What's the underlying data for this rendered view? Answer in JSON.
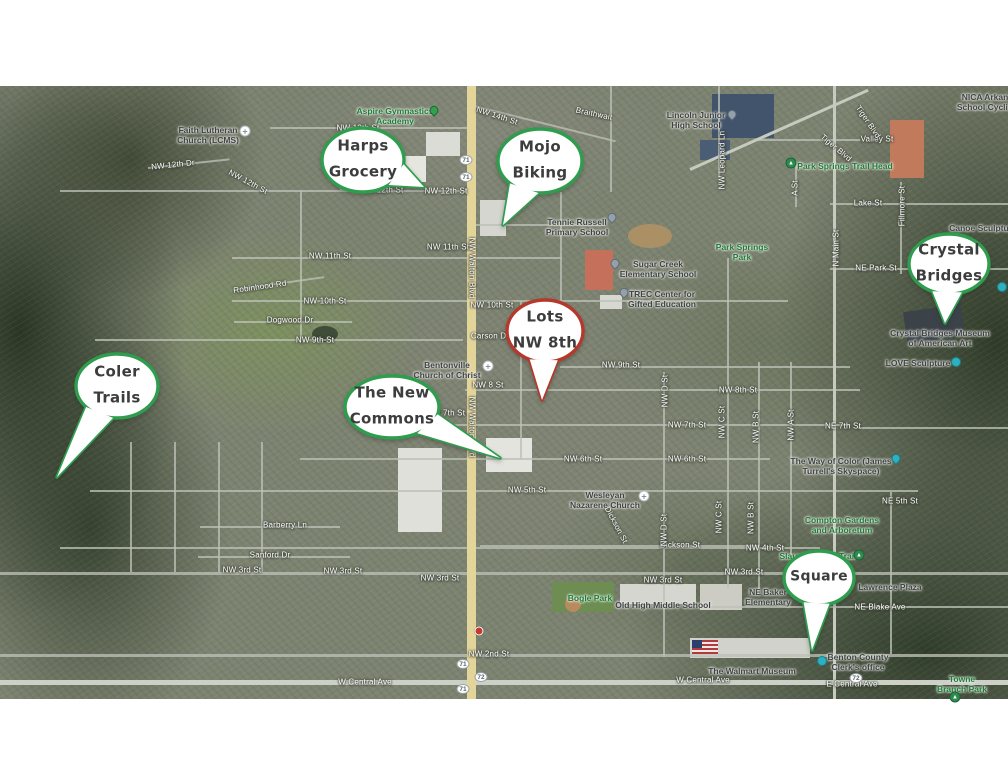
{
  "map": {
    "colors": {
      "callout_green": "#2f9d4e",
      "callout_red": "#b5392b",
      "highway_yellow": "#e3d49a",
      "street_gray": "#bcc0b6"
    },
    "callouts": [
      {
        "id": "harps-grocery",
        "lines": [
          "Harps",
          "Grocery"
        ],
        "cx": 363,
        "cy": 160,
        "rx": 41,
        "ry": 32,
        "tip": [
          424,
          187
        ],
        "color": "#2f9d4e"
      },
      {
        "id": "mojo-biking",
        "lines": [
          "Mojo",
          "Biking"
        ],
        "cx": 540,
        "cy": 161,
        "rx": 42,
        "ry": 32,
        "tip": [
          503,
          225
        ],
        "color": "#2f9d4e"
      },
      {
        "id": "crystal-bridges",
        "lines": [
          "Crystal",
          "Bridges"
        ],
        "cx": 949,
        "cy": 264,
        "rx": 40,
        "ry": 30,
        "tip": [
          945,
          323
        ],
        "color": "#2f9d4e"
      },
      {
        "id": "lots-nw-8th",
        "lines": [
          "Lots",
          "NW 8th"
        ],
        "cx": 545,
        "cy": 331,
        "rx": 38,
        "ry": 31,
        "tip": [
          542,
          400
        ],
        "color": "#b5392b"
      },
      {
        "id": "coler-trails",
        "lines": [
          "Coler",
          "Trails"
        ],
        "cx": 117,
        "cy": 386,
        "rx": 41,
        "ry": 32,
        "tip": [
          57,
          477
        ],
        "color": "#2f9d4e"
      },
      {
        "id": "the-new-commons",
        "lines": [
          "The New",
          "Commons"
        ],
        "cx": 392,
        "cy": 407,
        "rx": 47,
        "ry": 31,
        "tip": [
          500,
          458
        ],
        "color": "#2f9d4e"
      },
      {
        "id": "square",
        "lines": [
          "Square"
        ],
        "cx": 819,
        "cy": 578,
        "rx": 35,
        "ry": 27,
        "tip": [
          812,
          650
        ],
        "color": "#2f9d4e"
      }
    ],
    "roads": [
      {
        "x": 270,
        "y": 127,
        "w": 200,
        "h": 2
      },
      {
        "x": 470,
        "y": 104,
        "w": 150,
        "h": 2,
        "r": 14
      },
      {
        "x": 60,
        "y": 190,
        "w": 408,
        "h": 2
      },
      {
        "x": 148,
        "y": 167,
        "w": 82,
        "h": 2,
        "r": -6
      },
      {
        "x": 470,
        "y": 224,
        "w": 135,
        "h": 2
      },
      {
        "x": 232,
        "y": 257,
        "w": 330,
        "h": 2
      },
      {
        "x": 232,
        "y": 300,
        "w": 556,
        "h": 2
      },
      {
        "x": 95,
        "y": 339,
        "w": 368,
        "h": 2
      },
      {
        "x": 560,
        "y": 366,
        "w": 290,
        "h": 2
      },
      {
        "x": 465,
        "y": 389,
        "w": 395,
        "h": 2
      },
      {
        "x": 380,
        "y": 424,
        "w": 470,
        "h": 2
      },
      {
        "x": 858,
        "y": 427,
        "w": 150,
        "h": 2
      },
      {
        "x": 300,
        "y": 458,
        "w": 470,
        "h": 2
      },
      {
        "x": 90,
        "y": 490,
        "w": 828,
        "h": 2
      },
      {
        "x": 60,
        "y": 547,
        "w": 760,
        "h": 2
      },
      {
        "x": 0,
        "y": 572,
        "w": 1008,
        "h": 3
      },
      {
        "x": 480,
        "y": 545,
        "w": 280,
        "h": 2
      },
      {
        "x": 700,
        "y": 606,
        "w": 308,
        "h": 2
      },
      {
        "x": 0,
        "y": 654,
        "w": 1008,
        "h": 3
      },
      {
        "x": 0,
        "y": 680,
        "w": 1008,
        "h": 5,
        "c": "#cdd0c7"
      },
      {
        "x": 830,
        "y": 203,
        "w": 178,
        "h": 2
      },
      {
        "x": 830,
        "y": 268,
        "w": 178,
        "h": 2
      },
      {
        "x": 755,
        "y": 139,
        "w": 105,
        "h": 2
      },
      {
        "x": 233,
        "y": 289,
        "w": 92,
        "h": 2,
        "r": -8
      },
      {
        "x": 234,
        "y": 321,
        "w": 118,
        "h": 2
      },
      {
        "x": 200,
        "y": 526,
        "w": 140,
        "h": 2
      },
      {
        "x": 198,
        "y": 556,
        "w": 152,
        "h": 2
      },
      {
        "x": 467,
        "y": 86,
        "w": 9,
        "h": 613,
        "c": "#e3d49a"
      },
      {
        "x": 833,
        "y": 86,
        "w": 3,
        "h": 613,
        "c": "#c6cabf"
      },
      {
        "x": 663,
        "y": 372,
        "w": 2,
        "h": 285
      },
      {
        "x": 727,
        "y": 258,
        "w": 2,
        "h": 330
      },
      {
        "x": 758,
        "y": 362,
        "w": 2,
        "h": 228
      },
      {
        "x": 790,
        "y": 362,
        "w": 2,
        "h": 196
      },
      {
        "x": 900,
        "y": 182,
        "w": 2,
        "h": 92
      },
      {
        "x": 610,
        "y": 86,
        "w": 2,
        "h": 106
      },
      {
        "x": 560,
        "y": 192,
        "w": 2,
        "h": 110
      },
      {
        "x": 340,
        "y": 128,
        "w": 2,
        "h": 62
      },
      {
        "x": 300,
        "y": 191,
        "w": 2,
        "h": 148
      },
      {
        "x": 130,
        "y": 442,
        "w": 2,
        "h": 130
      },
      {
        "x": 174,
        "y": 442,
        "w": 2,
        "h": 130
      },
      {
        "x": 218,
        "y": 442,
        "w": 2,
        "h": 130
      },
      {
        "x": 261,
        "y": 442,
        "w": 2,
        "h": 130
      },
      {
        "x": 520,
        "y": 301,
        "w": 2,
        "h": 158
      },
      {
        "x": 718,
        "y": 86,
        "w": 2,
        "h": 92
      },
      {
        "x": 795,
        "y": 161,
        "w": 2,
        "h": 46
      },
      {
        "x": 890,
        "y": 492,
        "w": 2,
        "h": 162
      },
      {
        "x": 690,
        "y": 168,
        "w": 195,
        "h": 3,
        "r": -24,
        "c": "#c6cabf"
      }
    ],
    "labels": [
      {
        "t": "NW 13th St",
        "x": 358,
        "y": 128,
        "k": "street"
      },
      {
        "t": "NW 14th St",
        "x": 497,
        "y": 116,
        "k": "street",
        "r": 18
      },
      {
        "t": "NW 12th St",
        "x": 446,
        "y": 191,
        "k": "street"
      },
      {
        "t": "NW 12th St",
        "x": 382,
        "y": 190,
        "k": "street"
      },
      {
        "t": "NW 12th Dr",
        "x": 173,
        "y": 165,
        "k": "street",
        "r": -6
      },
      {
        "t": "NW 12th St",
        "x": 248,
        "y": 182,
        "k": "street",
        "r": 28
      },
      {
        "t": "NW 11th St",
        "x": 330,
        "y": 256,
        "k": "street"
      },
      {
        "t": "NW 11th St",
        "x": 448,
        "y": 247,
        "k": "street"
      },
      {
        "t": "NW 10th St",
        "x": 325,
        "y": 301,
        "k": "street"
      },
      {
        "t": "NW 10th St",
        "x": 492,
        "y": 305,
        "k": "street"
      },
      {
        "t": "NW 9th St",
        "x": 315,
        "y": 340,
        "k": "street"
      },
      {
        "t": "NW 9th St",
        "x": 621,
        "y": 365,
        "k": "street"
      },
      {
        "t": "NW 8 St",
        "x": 488,
        "y": 385,
        "k": "street"
      },
      {
        "t": "NW 8th St",
        "x": 738,
        "y": 390,
        "k": "street"
      },
      {
        "t": "NW 7th St",
        "x": 446,
        "y": 413,
        "k": "street"
      },
      {
        "t": "NW 7th St",
        "x": 687,
        "y": 425,
        "k": "street"
      },
      {
        "t": "NE 7th St",
        "x": 843,
        "y": 426,
        "k": "street"
      },
      {
        "t": "NW 6th St",
        "x": 583,
        "y": 459,
        "k": "street"
      },
      {
        "t": "NW 6th St",
        "x": 687,
        "y": 459,
        "k": "street"
      },
      {
        "t": "NW 5th St",
        "x": 527,
        "y": 490,
        "k": "street"
      },
      {
        "t": "NE 5th St",
        "x": 900,
        "y": 501,
        "k": "street"
      },
      {
        "t": "NW 4th St",
        "x": 765,
        "y": 548,
        "k": "street"
      },
      {
        "t": "NW 3rd St",
        "x": 242,
        "y": 570,
        "k": "street"
      },
      {
        "t": "NW 3rd St",
        "x": 343,
        "y": 571,
        "k": "street"
      },
      {
        "t": "NW 3rd St",
        "x": 440,
        "y": 578,
        "k": "street"
      },
      {
        "t": "NW 3rd St",
        "x": 663,
        "y": 580,
        "k": "street"
      },
      {
        "t": "NW 3rd St",
        "x": 744,
        "y": 572,
        "k": "street"
      },
      {
        "t": "NW 2nd St",
        "x": 489,
        "y": 654,
        "k": "street"
      },
      {
        "t": "W Central Ave",
        "x": 365,
        "y": 682,
        "k": "street"
      },
      {
        "t": "W Central Ave",
        "x": 703,
        "y": 680,
        "k": "street"
      },
      {
        "t": "E Central Ave",
        "x": 852,
        "y": 684,
        "k": "street"
      },
      {
        "t": "NE Blake Ave",
        "x": 880,
        "y": 607,
        "k": "street"
      },
      {
        "t": "Dickson St",
        "x": 616,
        "y": 525,
        "k": "street",
        "r": 62
      },
      {
        "t": "Dickson St",
        "x": 680,
        "y": 545,
        "k": "street"
      },
      {
        "t": "Barberry Ln",
        "x": 285,
        "y": 525,
        "k": "street"
      },
      {
        "t": "Sanford Dr",
        "x": 270,
        "y": 555,
        "k": "street"
      },
      {
        "t": "Carson Dr",
        "x": 490,
        "y": 336,
        "k": "street"
      },
      {
        "t": "Robinhood Rd",
        "x": 260,
        "y": 287,
        "k": "street",
        "r": -8
      },
      {
        "t": "Dogwood Dr",
        "x": 290,
        "y": 320,
        "k": "street"
      },
      {
        "t": "Lake St",
        "x": 868,
        "y": 203,
        "k": "street"
      },
      {
        "t": "Valley St",
        "x": 877,
        "y": 139,
        "k": "street"
      },
      {
        "t": "NE Park St",
        "x": 876,
        "y": 268,
        "k": "street"
      },
      {
        "t": "Tiger Blvd",
        "x": 868,
        "y": 122,
        "k": "street",
        "r": 56
      },
      {
        "t": "Tiger Blvd",
        "x": 836,
        "y": 148,
        "k": "street",
        "r": 40
      },
      {
        "t": "Braithwait",
        "x": 594,
        "y": 114,
        "k": "street",
        "r": 12
      },
      {
        "t": "NW Walton Blvd",
        "x": 472,
        "y": 427,
        "k": "street",
        "r": 90
      },
      {
        "t": "NW Walton Blvd",
        "x": 472,
        "y": 268,
        "k": "street",
        "r": 90
      },
      {
        "t": "N Main St",
        "x": 836,
        "y": 248,
        "k": "street",
        "r": -90
      },
      {
        "t": "Fillmore St",
        "x": 902,
        "y": 206,
        "k": "street",
        "r": -90
      },
      {
        "t": "NW Leopard Ln",
        "x": 722,
        "y": 160,
        "k": "street",
        "r": -90
      },
      {
        "t": "A St",
        "x": 795,
        "y": 188,
        "k": "street",
        "r": -90
      },
      {
        "t": "NW D St",
        "x": 665,
        "y": 391,
        "k": "street",
        "r": -90
      },
      {
        "t": "NW C St",
        "x": 722,
        "y": 422,
        "k": "street",
        "r": -90
      },
      {
        "t": "NW B St",
        "x": 756,
        "y": 427,
        "k": "street",
        "r": -90
      },
      {
        "t": "NW A St",
        "x": 791,
        "y": 425,
        "k": "street",
        "r": -90
      },
      {
        "t": "NW D St",
        "x": 664,
        "y": 530,
        "k": "street",
        "r": -90
      },
      {
        "t": "NW C St",
        "x": 719,
        "y": 517,
        "k": "street",
        "r": -90
      },
      {
        "t": "NW B St",
        "x": 751,
        "y": 518,
        "k": "street",
        "r": -90
      },
      {
        "t": "Faith Lutheran\nChurch (LCMS)",
        "x": 208,
        "y": 135,
        "k": "poi"
      },
      {
        "t": "Aspire Gymnastics\nAcademy",
        "x": 395,
        "y": 116,
        "k": "park"
      },
      {
        "t": "Lincoln Junior\nHigh School",
        "x": 696,
        "y": 120,
        "k": "poi"
      },
      {
        "t": "NICA Arkan\nSchool Cyclin",
        "x": 985,
        "y": 102,
        "k": "poi"
      },
      {
        "t": "Park Springs Trail Head",
        "x": 845,
        "y": 166,
        "k": "park"
      },
      {
        "t": "Park Springs\nPark",
        "x": 742,
        "y": 252,
        "k": "park"
      },
      {
        "t": "Tennie Russell\nPrimary School",
        "x": 577,
        "y": 227,
        "k": "poi"
      },
      {
        "t": "Sugar Creek\nElementary School",
        "x": 658,
        "y": 269,
        "k": "poi"
      },
      {
        "t": "TREC Center for\nGifted Education",
        "x": 662,
        "y": 299,
        "k": "poi"
      },
      {
        "t": "Canoe Sculpture",
        "x": 983,
        "y": 228,
        "k": "poi"
      },
      {
        "t": "Crystal Bridges Museum\nof American Art",
        "x": 940,
        "y": 338,
        "k": "poi"
      },
      {
        "t": "LOVE Sculpture",
        "x": 918,
        "y": 363,
        "k": "poi"
      },
      {
        "t": "Bentonville\nChurch of Christ",
        "x": 447,
        "y": 370,
        "k": "poi"
      },
      {
        "t": "The Way of Color (James\nTurrell's Skyspace)",
        "x": 841,
        "y": 466,
        "k": "poi"
      },
      {
        "t": "Compton Gardens\nand Arboretum",
        "x": 842,
        "y": 525,
        "k": "park"
      },
      {
        "t": "Wesleyan\nNazarene Church",
        "x": 605,
        "y": 500,
        "k": "poi"
      },
      {
        "t": "Slaughter Pen Trail",
        "x": 818,
        "y": 556,
        "k": "park"
      },
      {
        "t": "Bogle Park",
        "x": 590,
        "y": 598,
        "k": "park"
      },
      {
        "t": "Old High Middle School",
        "x": 663,
        "y": 605,
        "k": "poi"
      },
      {
        "t": "NE Baker\nElementary",
        "x": 768,
        "y": 597,
        "k": "poi"
      },
      {
        "t": "Lawrence Plaza",
        "x": 890,
        "y": 587,
        "k": "poi"
      },
      {
        "t": "The Walmart Museum",
        "x": 752,
        "y": 671,
        "k": "poi"
      },
      {
        "t": "Benton County\nClerk's office",
        "x": 858,
        "y": 662,
        "k": "poi"
      },
      {
        "t": "Towne\nBranch Park",
        "x": 962,
        "y": 684,
        "k": "park"
      }
    ],
    "markers": [
      {
        "k": "pin-green",
        "x": 434,
        "y": 114
      },
      {
        "k": "pin-gray",
        "x": 732,
        "y": 118
      },
      {
        "k": "pin-gray",
        "x": 612,
        "y": 221
      },
      {
        "k": "pin-gray",
        "x": 615,
        "y": 267
      },
      {
        "k": "pin-gray",
        "x": 624,
        "y": 296
      },
      {
        "k": "tree-green",
        "x": 791,
        "y": 163
      },
      {
        "k": "tree-green",
        "x": 859,
        "y": 555
      },
      {
        "k": "tree-green",
        "x": 955,
        "y": 697
      },
      {
        "k": "circ-teal",
        "x": 956,
        "y": 362
      },
      {
        "k": "pin-teal",
        "x": 896,
        "y": 462
      },
      {
        "k": "circ-teal",
        "x": 1002,
        "y": 287
      },
      {
        "k": "circ-teal",
        "x": 822,
        "y": 661
      },
      {
        "k": "dot-red",
        "x": 411,
        "y": 181
      },
      {
        "k": "dot-red",
        "x": 479,
        "y": 631
      },
      {
        "k": "church",
        "x": 245,
        "y": 131
      },
      {
        "k": "church",
        "x": 488,
        "y": 366
      },
      {
        "k": "church",
        "x": 644,
        "y": 496
      },
      {
        "k": "shield",
        "x": 466,
        "y": 160,
        "t": "71"
      },
      {
        "k": "shield",
        "x": 466,
        "y": 177,
        "t": "71"
      },
      {
        "k": "shield",
        "x": 463,
        "y": 664,
        "t": "71"
      },
      {
        "k": "shield",
        "x": 481,
        "y": 677,
        "t": "72"
      },
      {
        "k": "shield",
        "x": 463,
        "y": 689,
        "t": "71"
      },
      {
        "k": "shield",
        "x": 856,
        "y": 678,
        "t": "72"
      }
    ]
  }
}
